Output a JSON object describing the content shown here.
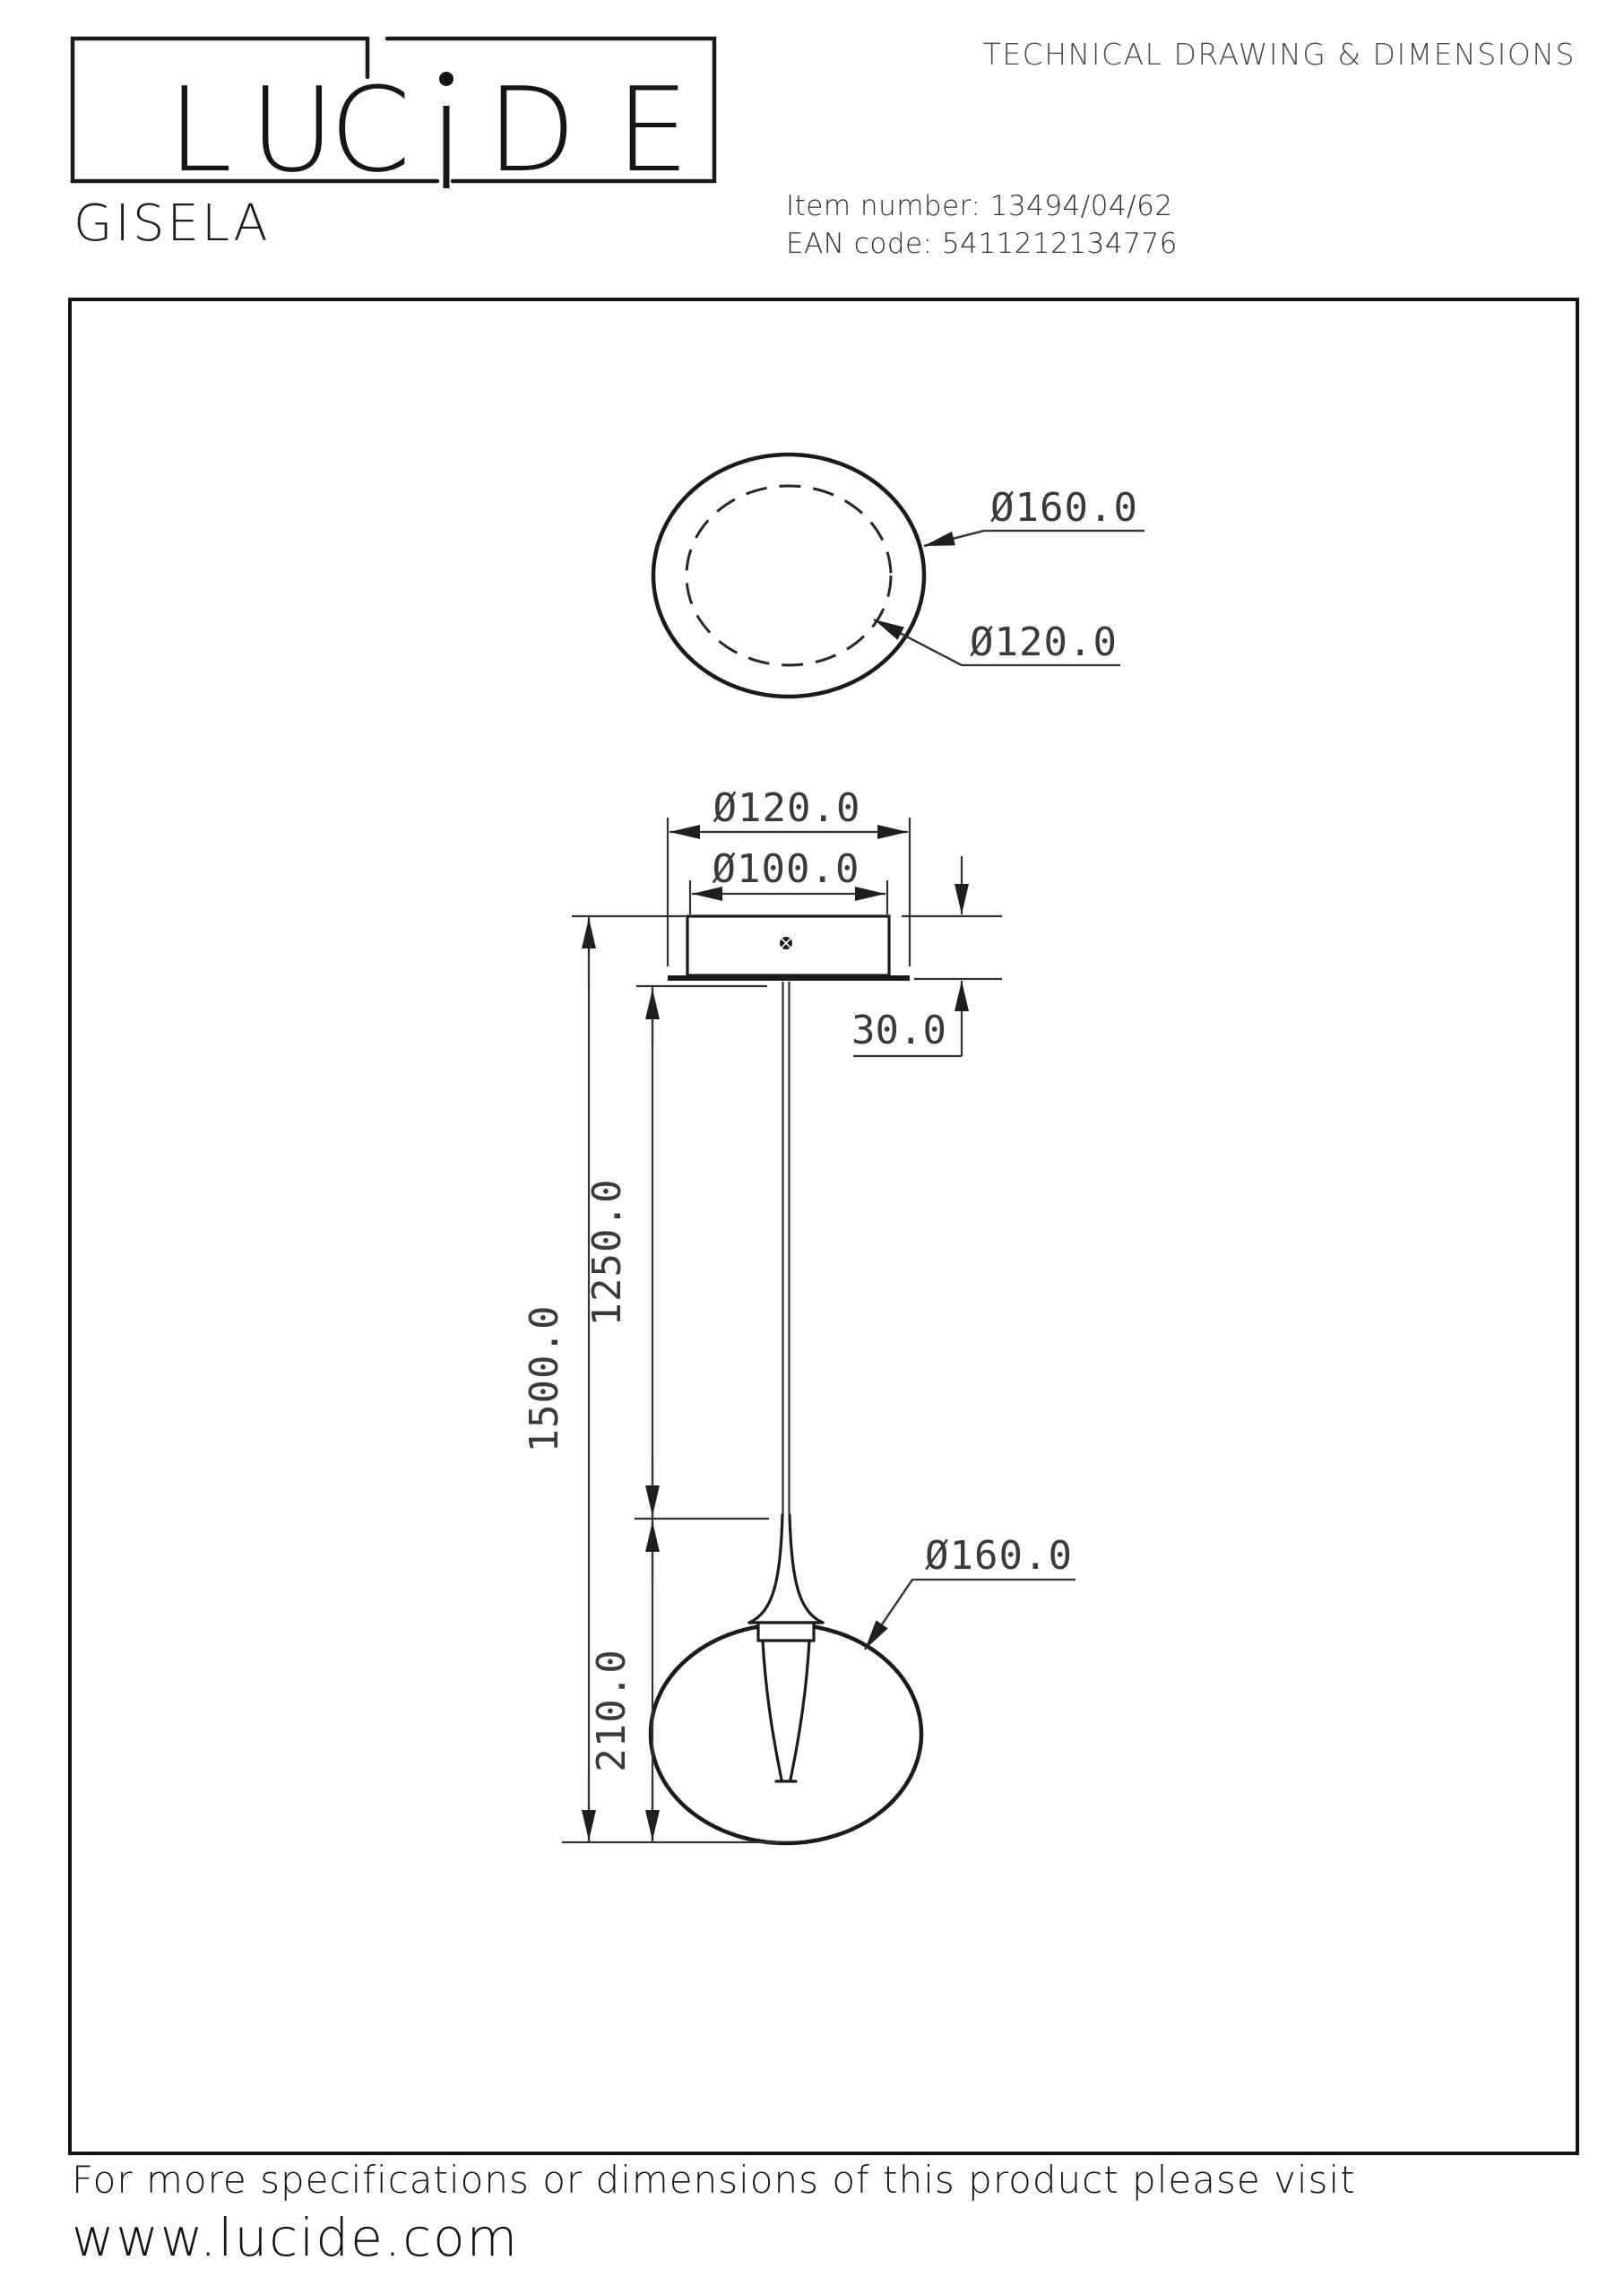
{
  "header": {
    "logo": {
      "letters": [
        "L",
        "U",
        "C",
        "i",
        "D",
        "E"
      ]
    },
    "doc_title": "TECHNICAL DRAWING & DIMENSIONS",
    "product_name": "GISELA",
    "item_number_line": "Item number: 13494/04/62",
    "ean_code_line": "EAN code: 5411212134776"
  },
  "drawing": {
    "top_view": {
      "outer_diameter": "Ø160.0",
      "inner_diameter": "Ø120.0"
    },
    "front_view": {
      "canopy_diameter": "Ø120.0",
      "canopy_fixing_diameter": "Ø100.0",
      "canopy_height": "30.0",
      "total_drop": "1500.0",
      "suspension_length": "1250.0",
      "lamp_height": "210.0",
      "shade_diameter": "Ø160.0"
    }
  },
  "footer": {
    "note": "For more specifications or dimensions of this product please visit",
    "website": "www.lucide.com"
  }
}
